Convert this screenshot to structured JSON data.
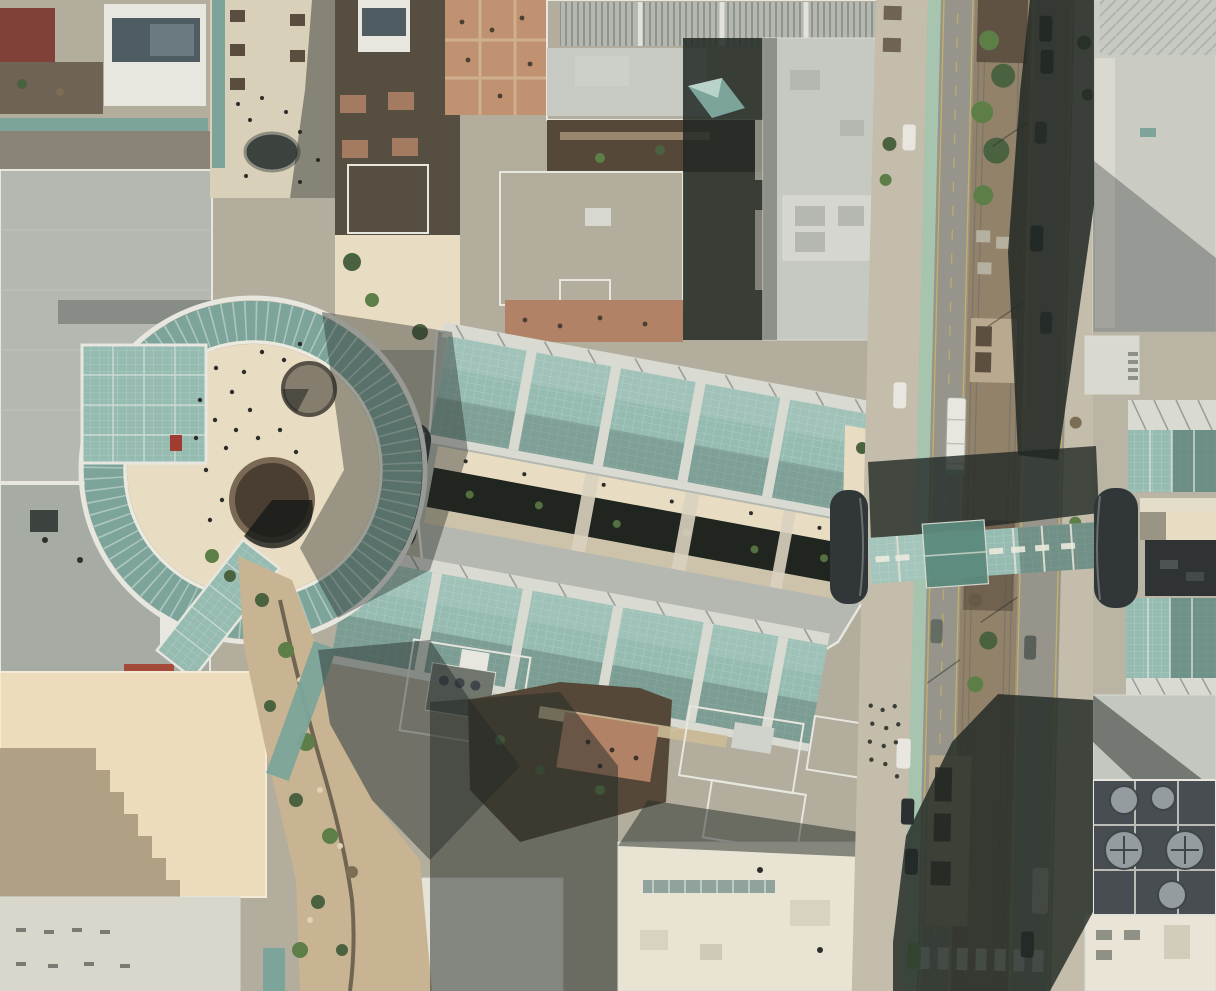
{
  "image": {
    "kind": "aerial-satellite-photograph",
    "description": "Top-down aerial view of a downtown shopping center: a circular glass-roofed rotunda plaza with fountains, two long tilted retractable glass arcade roofs flanking an open-air creek walkway, a glass sky bridge with dark barrel-vault ends crossing a light-rail street, surrounding rooftops, roof gardens, street with median trees, station platforms, cars and long building shadows.",
    "width_px": 1216,
    "height_px": 991
  },
  "palette": {
    "base": "#b2ad9d",
    "plaza": "#e8ddc2",
    "walk": "#d8d0b8",
    "sidewalk": "#c4bdab",
    "road": "#97958b",
    "median": "#93826a",
    "planter": "#5a4c3e",
    "bike": "#a6c4ae",
    "yellow": "#c3b166",
    "rail": "#74736a",
    "roofA": "#b4b8b0",
    "roofB": "#c7cac2",
    "roofC": "#a6aba3",
    "roofWhite": "#e7e6df",
    "roofCream": "#e9e3d3",
    "roofBeige": "#eddcbc",
    "roofDark": "#4f5d63",
    "roofBrown": "#564838",
    "brick": "#b28266",
    "brickPath": "#d2bd9b",
    "maroon": "#7f4138",
    "glass": "#96bcb2",
    "glassPale": "#c6dcd2",
    "glassMid": "#7ca49a",
    "glassShade": "#4f6f68",
    "frame": "#d9dbd3",
    "barrel": "#313738",
    "shadow": "#222925",
    "creek": "#20261f",
    "rock": "#c8b492",
    "tree": "#4b6240",
    "treeBright": "#5e7e48",
    "treeDry": "#7c6e54",
    "carDark": "#2b3033",
    "carWhite": "#e8e6de",
    "carGreen": "#78b465",
    "white": "#f1f0e9",
    "fan": "#959ca0",
    "fanDark": "#3f464a"
  },
  "features": [
    "glass-rotunda-ring-plaza",
    "plaza-fountains",
    "retractable-glass-arcade-north",
    "retractable-glass-arcade-south",
    "open-air-creek-walkway",
    "sky-bridge-over-street",
    "barrel-vault-roof-ends",
    "light-rail-street-with-median",
    "light-rail-station-platforms",
    "pedestrian-mall",
    "roof-gardens",
    "stepped-tower-shadow",
    "rooftop-hvac-fans",
    "creek-rock-garden"
  ]
}
